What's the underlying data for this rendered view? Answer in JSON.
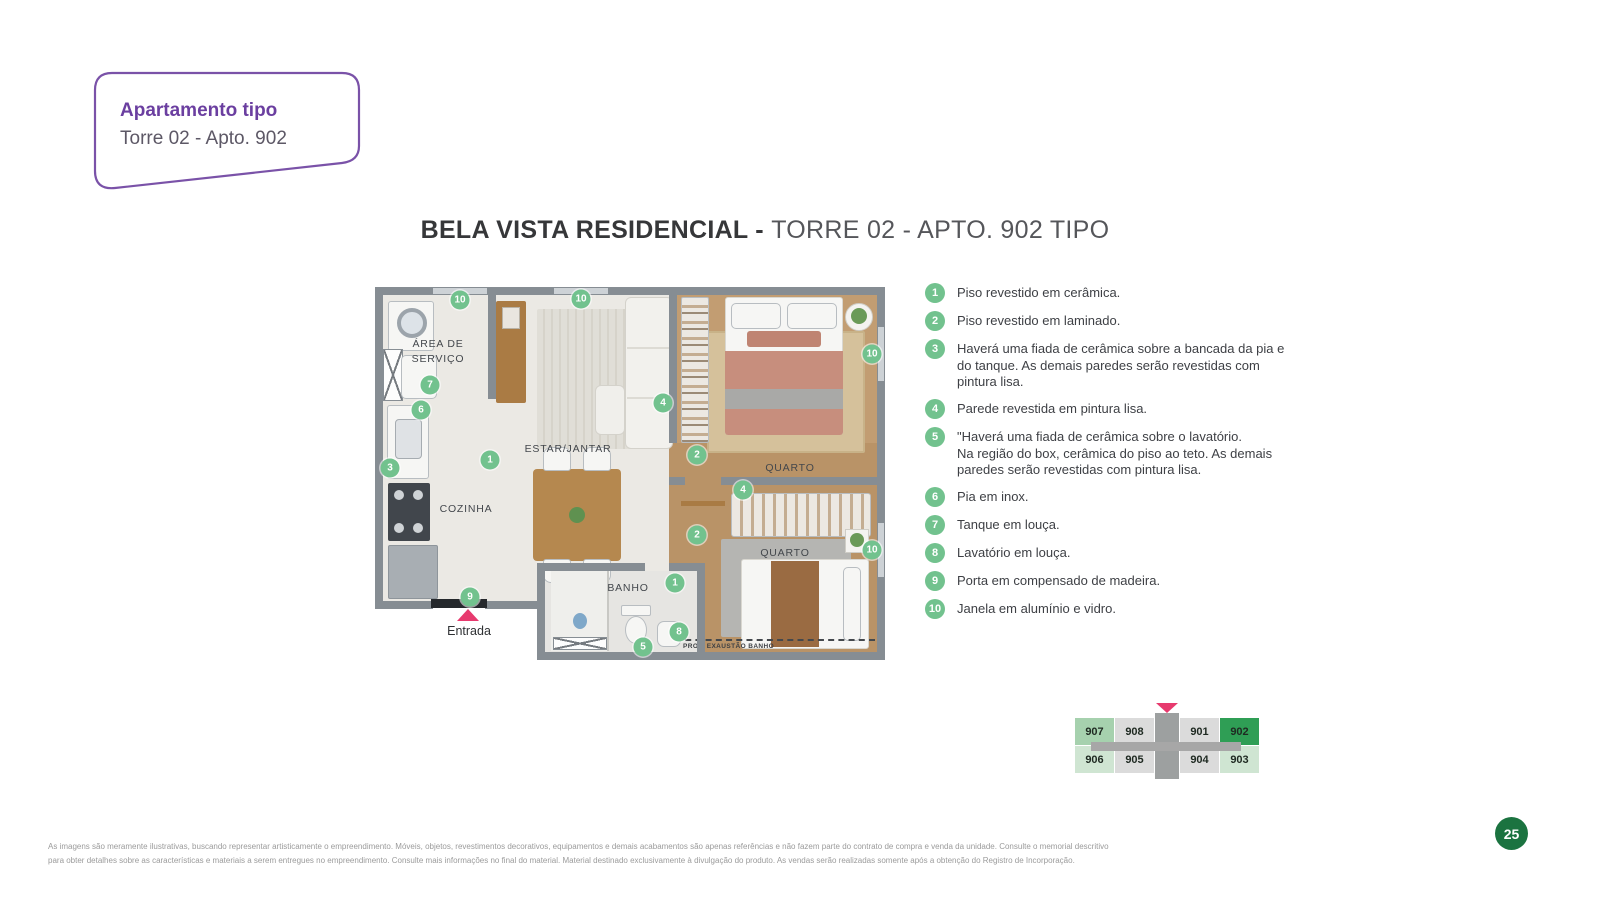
{
  "callout": {
    "title": "Apartamento tipo",
    "subtitle": "Torre 02 - Apto. 902"
  },
  "main_title": {
    "bold": "BELA VISTA RESIDENCIAL - ",
    "light": "TORRE 02 - APTO. 902 TIPO"
  },
  "floor_plan": {
    "labels": {
      "area_servico_line1": "ÁREA DE",
      "area_servico_line2": "SERVIÇO",
      "estar_jantar": "ESTAR/JANTAR",
      "cozinha": "COZINHA",
      "quarto_1": "QUARTO",
      "quarto_2": "QUARTO",
      "banho": "BANHO",
      "exaustao": "PROJ. EXAUSTÃO BANHO",
      "entrada": "Entrada"
    },
    "markers": [
      {
        "n": "10",
        "x": 85,
        "y": 13
      },
      {
        "n": "10",
        "x": 206,
        "y": 12
      },
      {
        "n": "10",
        "x": 497,
        "y": 67
      },
      {
        "n": "10",
        "x": 497,
        "y": 263
      },
      {
        "n": "7",
        "x": 55,
        "y": 98
      },
      {
        "n": "6",
        "x": 46,
        "y": 123
      },
      {
        "n": "3",
        "x": 15,
        "y": 181
      },
      {
        "n": "1",
        "x": 115,
        "y": 173
      },
      {
        "n": "4",
        "x": 288,
        "y": 116
      },
      {
        "n": "2",
        "x": 322,
        "y": 168
      },
      {
        "n": "4",
        "x": 368,
        "y": 203
      },
      {
        "n": "2",
        "x": 322,
        "y": 248
      },
      {
        "n": "1",
        "x": 300,
        "y": 296
      },
      {
        "n": "9",
        "x": 95,
        "y": 310
      },
      {
        "n": "8",
        "x": 304,
        "y": 345
      },
      {
        "n": "5",
        "x": 268,
        "y": 360
      }
    ]
  },
  "legend": {
    "items": [
      {
        "num": "1",
        "text": "Piso revestido em cerâmica."
      },
      {
        "num": "2",
        "text": "Piso revestido em laminado."
      },
      {
        "num": "3",
        "text": "Haverá uma fiada de cerâmica sobre a bancada da pia e do tanque. As demais paredes serão revestidas com pintura lisa."
      },
      {
        "num": "4",
        "text": "Parede revestida em pintura lisa."
      },
      {
        "num": "5",
        "text": "\"Haverá uma fiada de cerâmica sobre o lavatório.\nNa região do box, cerâmica do piso ao teto. As demais paredes serão revestidas com pintura lisa."
      },
      {
        "num": "6",
        "text": "Pia em inox."
      },
      {
        "num": "7",
        "text": "Tanque em louça."
      },
      {
        "num": "8",
        "text": "Lavatório em louça."
      },
      {
        "num": "9",
        "text": "Porta em compensado de madeira."
      },
      {
        "num": "10",
        "text": "Janela em alumínio e vidro."
      }
    ]
  },
  "unit_map": {
    "rows": [
      [
        {
          "label": "907",
          "tone": "green-mid"
        },
        {
          "label": "908",
          "tone": "gray"
        },
        {
          "label": "901",
          "tone": "gray"
        },
        {
          "label": "902",
          "tone": "green-dark"
        }
      ],
      [
        {
          "label": "906",
          "tone": "green-light"
        },
        {
          "label": "905",
          "tone": "gray"
        },
        {
          "label": "904",
          "tone": "gray"
        },
        {
          "label": "903",
          "tone": "green-light"
        }
      ]
    ],
    "highlighted_unit": "902"
  },
  "footer": {
    "line1": "As imagens são meramente ilustrativas, buscando representar artisticamente o empreendimento. Móveis, objetos, revestimentos decorativos, equipamentos e demais acabamentos são apenas referências e não fazem parte do contrato de compra e venda da unidade. Consulte o memorial descritivo",
    "line2": "para obter detalhes sobre as características e materiais a serem entregues no empreendimento. Consulte mais informações no final do material. Material destinado exclusivamente à divulgação do produto. As vendas serão realizadas somente após a obtenção do Registro de Incorporação."
  },
  "page_number": "25",
  "colors": {
    "accent_purple": "#6b3fa0",
    "marker_green": "#72c28e",
    "unit_highlight_green": "#2f9e55",
    "entrance_pink": "#e73a6e",
    "page_circle_green": "#1b7340",
    "wall_gray": "#868d93"
  }
}
